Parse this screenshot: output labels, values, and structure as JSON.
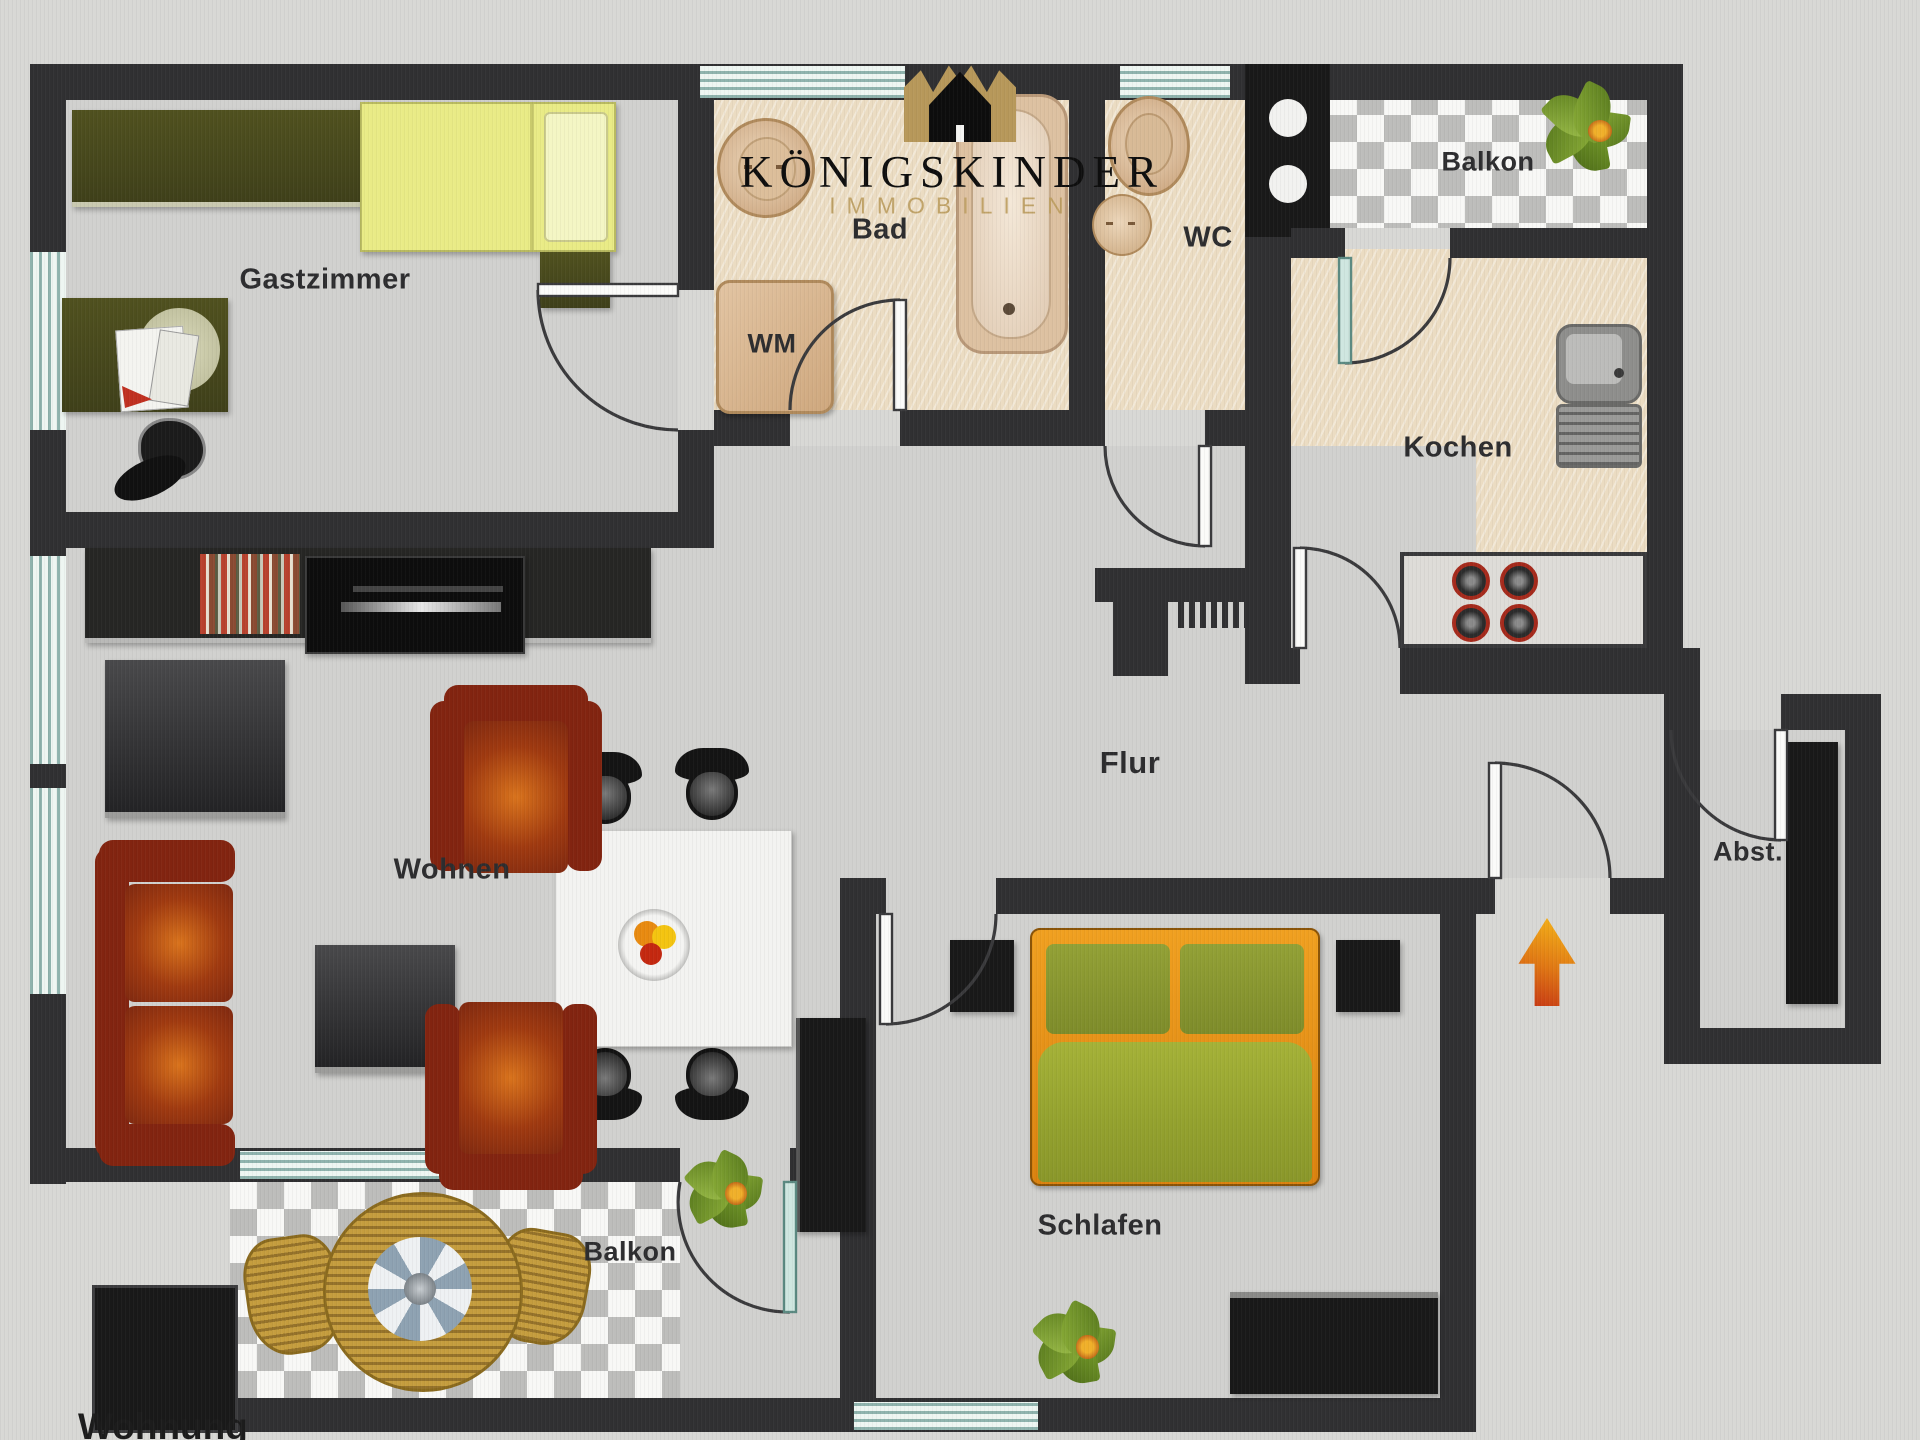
{
  "logo": {
    "brand": "KÖNIGSKINDER",
    "subtitle": "IMMOBILIEN",
    "icon": "crown-house-icon",
    "brand_color": "#0e0e0e",
    "gold_color": "#b99a5a"
  },
  "floorplan": {
    "type": "apartment-floor-plan",
    "rooms": {
      "gastzimmer": {
        "label": "Gastzimmer"
      },
      "bad": {
        "label": "Bad"
      },
      "wm": {
        "label": "WM"
      },
      "wc": {
        "label": "WC"
      },
      "balkon_top": {
        "label": "Balkon"
      },
      "kochen": {
        "label": "Kochen"
      },
      "flur": {
        "label": "Flur"
      },
      "wohnen": {
        "label": "Wohnen"
      },
      "schlafen": {
        "label": "Schlafen"
      },
      "abstellraum": {
        "label": "Abst."
      },
      "balkon_bottom": {
        "label": "Balkon"
      }
    },
    "caption": "Wohnung",
    "entry_marker": "arrow-up-icon",
    "colors": {
      "wall": "#303032",
      "floor_gray": "#d1d1cf",
      "floor_beige": "#ebdcc2",
      "window_teal": "#8fb3ad",
      "sofa_red": "#8e2f0f",
      "bed_yellow": "#e9eb86",
      "bed_orange": "#e08414",
      "bed_green": "#98a62e",
      "wicker_gold": "#c59d3e",
      "arrow_orange": "#e07714"
    }
  }
}
